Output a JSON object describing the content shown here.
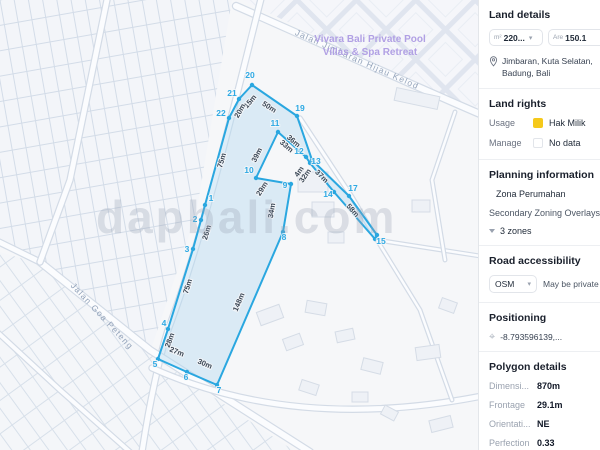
{
  "map": {
    "watermark": "dapbali.com",
    "poi": {
      "line1": "Vivara Bali Private Pool",
      "line2": "Villas & Spa Retreat",
      "x": 370,
      "y": 33
    },
    "road_labels": [
      {
        "text": "Jalan Jimbaran Hijau Kelod",
        "x": 356,
        "y": 62,
        "rot": 24
      },
      {
        "text": "Jalan Goa Peteng",
        "x": 100,
        "y": 318,
        "rot": 47
      }
    ],
    "parcel": {
      "stroke": "#2aa7e0",
      "fill": "rgba(178,216,240,0.42)",
      "vertices": [
        {
          "n": "1",
          "x": 205,
          "y": 205,
          "lx": 211,
          "ly": 201
        },
        {
          "n": "2",
          "x": 201,
          "y": 220,
          "lx": 195,
          "ly": 222
        },
        {
          "n": "3",
          "x": 193,
          "y": 249,
          "lx": 187,
          "ly": 252
        },
        {
          "n": "4",
          "x": 168,
          "y": 329,
          "lx": 164,
          "ly": 326
        },
        {
          "n": "5",
          "x": 158,
          "y": 359,
          "lx": 155,
          "ly": 367
        },
        {
          "n": "6",
          "x": 187,
          "y": 372,
          "lx": 186,
          "ly": 380
        },
        {
          "n": "7",
          "x": 217,
          "y": 385,
          "lx": 219,
          "ly": 393
        },
        {
          "n": "8",
          "x": 283,
          "y": 232,
          "lx": 284,
          "ly": 240
        },
        {
          "n": "9",
          "x": 291,
          "y": 184,
          "lx": 285,
          "ly": 188
        },
        {
          "n": "10",
          "x": 256,
          "y": 178,
          "lx": 249,
          "ly": 173
        },
        {
          "n": "11",
          "x": 278,
          "y": 132,
          "lx": 275,
          "ly": 126
        },
        {
          "n": "12",
          "x": 306,
          "y": 157,
          "lx": 299,
          "ly": 154
        },
        {
          "n": "13",
          "x": 310,
          "y": 163,
          "lx": 316,
          "ly": 164
        },
        {
          "n": "14",
          "x": 334,
          "y": 192,
          "lx": 328,
          "ly": 197
        },
        {
          "n": "15",
          "x": 375,
          "y": 239,
          "lx": 381,
          "ly": 244
        },
        {
          "n": "16",
          "x": 377,
          "y": 235,
          "lx": null,
          "ly": null
        },
        {
          "n": "17",
          "x": 349,
          "y": 196,
          "lx": 353,
          "ly": 191
        },
        {
          "n": "18",
          "x": 312,
          "y": 160,
          "lx": null,
          "ly": null
        },
        {
          "n": "19",
          "x": 297,
          "y": 116,
          "lx": 300,
          "ly": 111
        },
        {
          "n": "20",
          "x": 252,
          "y": 85,
          "lx": 250,
          "ly": 78
        },
        {
          "n": "21",
          "x": 239,
          "y": 99,
          "lx": 232,
          "ly": 96
        },
        {
          "n": "22",
          "x": 229,
          "y": 118,
          "lx": 221,
          "ly": 116
        }
      ],
      "segments": [
        {
          "text": "50m",
          "x": 268,
          "y": 109,
          "rot": 32
        },
        {
          "text": "15m",
          "x": 252,
          "y": 103,
          "rot": -50
        },
        {
          "text": "20m",
          "x": 242,
          "y": 112,
          "rot": -60
        },
        {
          "text": "75m",
          "x": 224,
          "y": 161,
          "rot": -74
        },
        {
          "text": "26m",
          "x": 209,
          "y": 233,
          "rot": -74
        },
        {
          "text": "75m",
          "x": 190,
          "y": 287,
          "rot": -73
        },
        {
          "text": "28m",
          "x": 172,
          "y": 341,
          "rot": -70
        },
        {
          "text": "27m",
          "x": 176,
          "y": 354,
          "rot": 22
        },
        {
          "text": "30m",
          "x": 204,
          "y": 366,
          "rot": 23
        },
        {
          "text": "148m",
          "x": 241,
          "y": 303,
          "rot": -67
        },
        {
          "text": "34m",
          "x": 274,
          "y": 211,
          "rot": -80
        },
        {
          "text": "29m",
          "x": 264,
          "y": 190,
          "rot": -58
        },
        {
          "text": "39m",
          "x": 259,
          "y": 156,
          "rot": -63
        },
        {
          "text": "33m",
          "x": 285,
          "y": 148,
          "rot": 41
        },
        {
          "text": "36m",
          "x": 292,
          "y": 143,
          "rot": 41
        },
        {
          "text": "4m",
          "x": 301,
          "y": 173,
          "rot": -55
        },
        {
          "text": "32m",
          "x": 307,
          "y": 177,
          "rot": -55
        },
        {
          "text": "37m",
          "x": 320,
          "y": 178,
          "rot": 45
        },
        {
          "text": "58m",
          "x": 351,
          "y": 212,
          "rot": 48
        }
      ]
    }
  },
  "sidebar": {
    "land_details": {
      "title": "Land details",
      "field1": {
        "prefix": "m²",
        "value": "220..."
      },
      "field2": {
        "prefix": "Are",
        "value": "150.1"
      },
      "location": "Jimbaran, Kuta Selatan, Badung, Bali"
    },
    "land_rights": {
      "title": "Land rights",
      "rows": [
        {
          "label": "Usage",
          "swatch": "#f5c91b",
          "value": "Hak Milik"
        },
        {
          "label": "Manage",
          "swatch": "",
          "value": "No data"
        }
      ]
    },
    "planning": {
      "title": "Planning information",
      "zone_swatch": "#f4e612",
      "zone": "Zona Perumahan",
      "overlays_label": "Secondary Zoning Overlays",
      "overlays_value": "3 zones"
    },
    "road": {
      "title": "Road accessibility",
      "select_value": "OSM",
      "note": "May be private"
    },
    "positioning": {
      "title": "Positioning",
      "coords": "-8.793596139,..."
    },
    "polygon": {
      "title": "Polygon details",
      "rows": [
        {
          "label": "Dimensi...",
          "value": "870m"
        },
        {
          "label": "Frontage",
          "value": "29.1m"
        },
        {
          "label": "Orientati...",
          "value": "NE"
        },
        {
          "label": "Perfection",
          "value": "0.33"
        }
      ]
    }
  }
}
